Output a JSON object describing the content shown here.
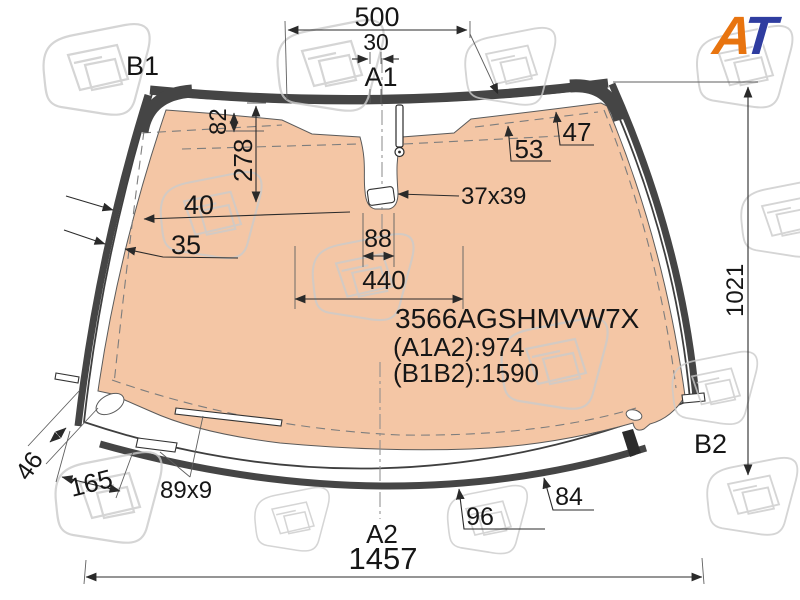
{
  "logo": {
    "a": "A",
    "t": "T"
  },
  "part": {
    "code": "3566AGSHMVW7X",
    "a1a2": "(A1A2):974",
    "b1b2": "(B1B2):1590"
  },
  "annotations": {
    "top_width": "500",
    "antenna_offset": "30",
    "point_a1": "A1",
    "point_b1": "B1",
    "point_b2": "B2",
    "point_a2": "A2",
    "top_edge_inset": "82",
    "mirror_drop": "278",
    "dash_inset_left": "40",
    "edge_inset_left": "35",
    "dash_inset_right_1": "53",
    "dash_inset_right_2": "47",
    "camera_window": "37x39",
    "mirror_width": "88",
    "mirror_zone_width": "440",
    "glass_height": "1021",
    "corner_width": "46",
    "bottom_corner_length": "165",
    "sensor_strip": "89x9",
    "bottom_inset_1": "84",
    "bottom_inset_2": "96",
    "bottom_width": "1457"
  },
  "colors": {
    "heated_zone": "#f4c6a5",
    "molding": "#454545",
    "logo_orange": "#e8740f",
    "logo_blue": "#2f3da0",
    "watermark": "#cbcbcb"
  }
}
